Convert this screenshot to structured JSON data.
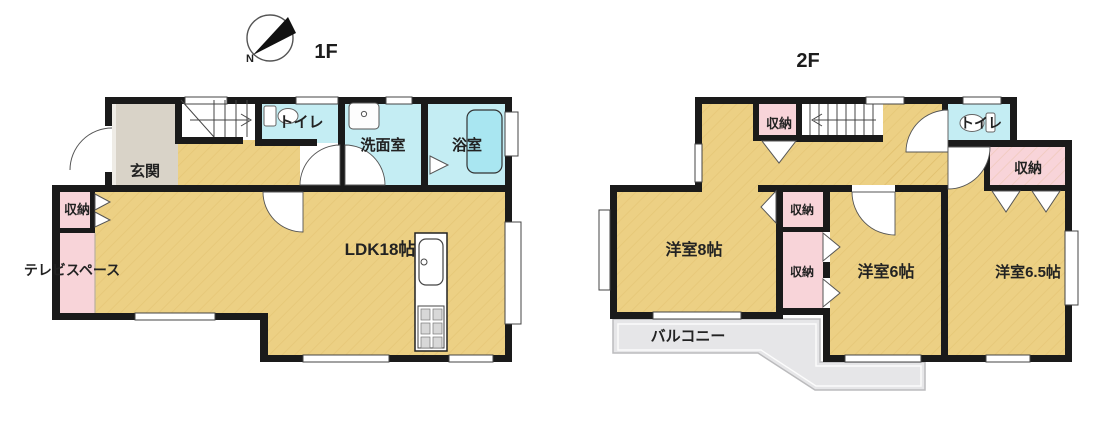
{
  "compass": {
    "north_label": "N"
  },
  "palette": {
    "floor_tan": "#ecd084",
    "wet_blue": "#c4edf3",
    "bathtub_blue": "#a9e6f1",
    "closet_pink": "#f8d4d9",
    "genkan_gray": "#d9d3c8",
    "balcony_gray": "#e6e6e8",
    "wall_black": "#1a1a1a",
    "background": "#ffffff"
  },
  "floors": [
    {
      "title": "1F",
      "rooms": [
        {
          "id": "genkan",
          "label": "玄関"
        },
        {
          "id": "toilet",
          "label": "トイレ"
        },
        {
          "id": "washroom",
          "label": "洗面室"
        },
        {
          "id": "bathroom",
          "label": "浴室"
        },
        {
          "id": "storage",
          "label": "収納"
        },
        {
          "id": "tv-space",
          "label": "テレビスペース"
        },
        {
          "id": "ldk",
          "label": "LDK18帖"
        }
      ]
    },
    {
      "title": "2F",
      "rooms": [
        {
          "id": "storage-top",
          "label": "収納"
        },
        {
          "id": "toilet",
          "label": "トイレ"
        },
        {
          "id": "storage-right",
          "label": "収納"
        },
        {
          "id": "storage-mid-upper",
          "label": "収納"
        },
        {
          "id": "storage-mid-lower",
          "label": "収納"
        },
        {
          "id": "western-room-8",
          "label": "洋室8帖"
        },
        {
          "id": "western-room-6",
          "label": "洋室6帖"
        },
        {
          "id": "western-room-6-5",
          "label": "洋室6.5帖"
        },
        {
          "id": "balcony",
          "label": "バルコニー"
        }
      ]
    }
  ]
}
